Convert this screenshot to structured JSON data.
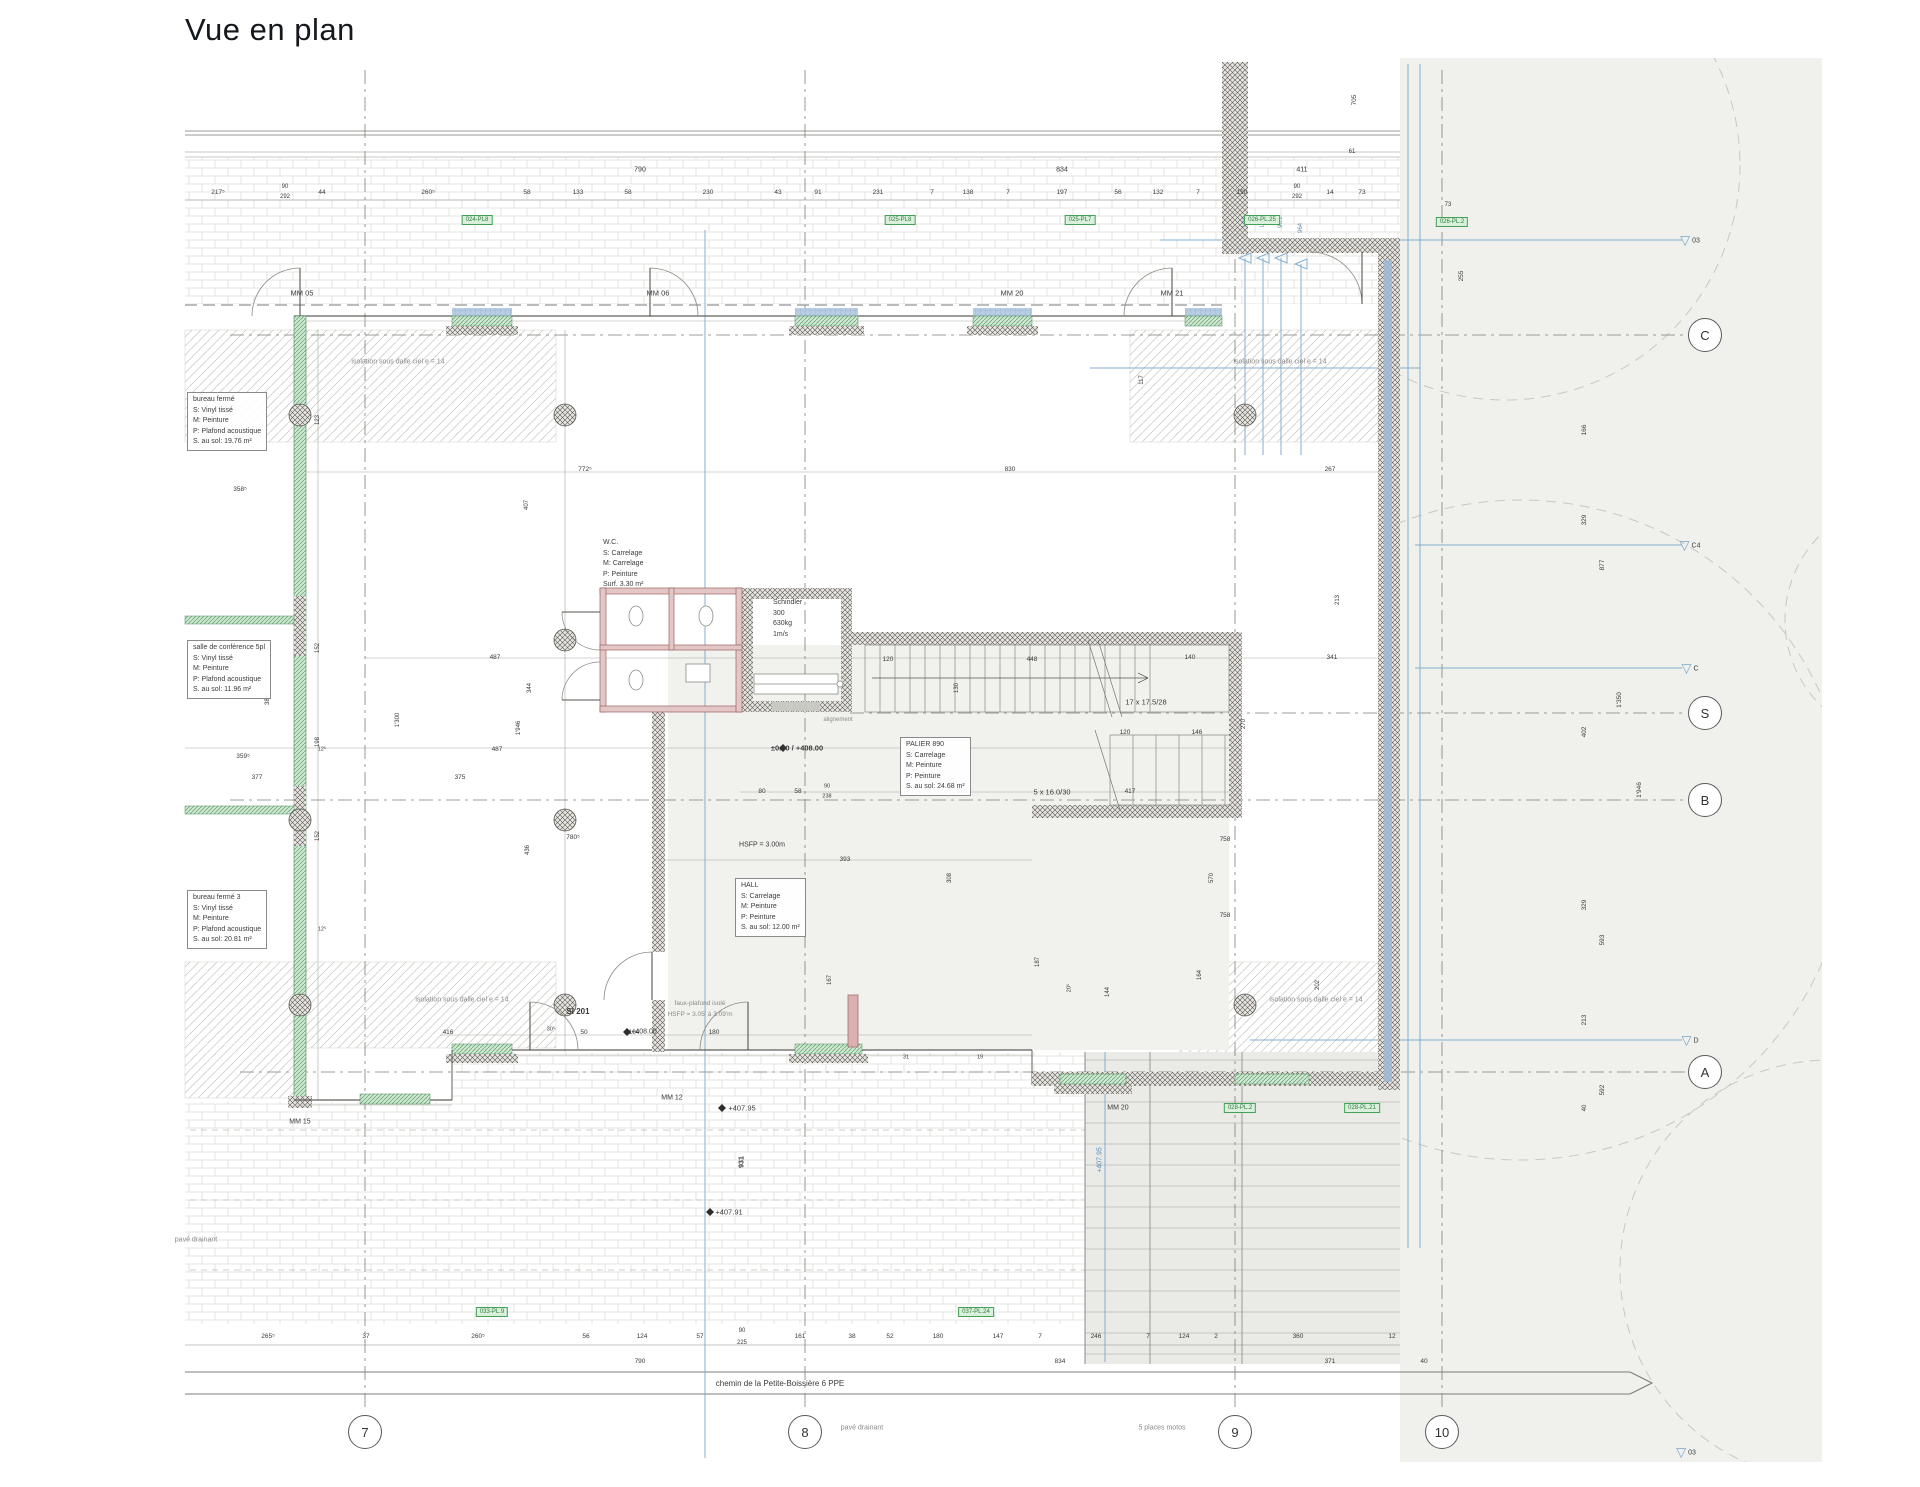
{
  "title": "Vue en plan",
  "colors": {
    "accent_green": "#43a056",
    "wall": "#5d5852",
    "glass": "#5fa06c",
    "blue_line": "#84aecf",
    "red_wall": "#9a6363"
  },
  "street": {
    "name_label": "chemin de la Petite-Boissière 6 PPE"
  },
  "grid": {
    "bubble_row_y": 1432,
    "bubble_col_x": 1705,
    "cols": [
      {
        "label": "7",
        "x": 365
      },
      {
        "label": "8",
        "x": 805
      },
      {
        "label": "9",
        "x": 1235
      },
      {
        "label": "10",
        "x": 1442
      }
    ],
    "rows": [
      {
        "label": "C",
        "y": 335
      },
      {
        "label": "S",
        "y": 713
      },
      {
        "label": "B",
        "y": 800
      },
      {
        "label": "A",
        "y": 1072
      }
    ],
    "triangles": [
      {
        "label": "03",
        "x": 1690,
        "y": 240
      },
      {
        "label": "C4",
        "x": 1690,
        "y": 545
      },
      {
        "label": "C",
        "x": 1690,
        "y": 668
      },
      {
        "label": "D",
        "x": 1690,
        "y": 1040
      },
      {
        "label": "03",
        "x": 1686,
        "y": 1452
      }
    ]
  },
  "rooms": [
    {
      "name": "bureau-ferme",
      "x": 187,
      "y": 392,
      "boxed": true,
      "lines": [
        "bureau fermé",
        "S: Vinyl tissé",
        "M: Peinture",
        "P: Plafond acoustique",
        "S. au sol: 19.76 m²"
      ]
    },
    {
      "name": "salle-de-conference",
      "x": 187,
      "y": 640,
      "boxed": true,
      "lines": [
        "salle de conférence 5pl",
        "S: Vinyl tissé",
        "M: Peinture",
        "P: Plafond acoustique",
        "S. au sol: 11.96 m²"
      ]
    },
    {
      "name": "bureau-ferme-3",
      "x": 187,
      "y": 890,
      "boxed": true,
      "lines": [
        "bureau fermé 3",
        "S: Vinyl tissé",
        "M: Peinture",
        "P: Plafond acoustique",
        "S. au sol: 20.81 m²"
      ]
    },
    {
      "name": "wc",
      "x": 598,
      "y": 536,
      "boxed": false,
      "lines": [
        "W.C.",
        "S: Carrelage",
        "M: Carrelage",
        "P: Peinture",
        "Surf. 3.30 m²"
      ]
    },
    {
      "name": "ascenseur",
      "x": 768,
      "y": 596,
      "boxed": false,
      "lines": [
        "Schindler",
        "300",
        "630kg",
        "1m/s"
      ]
    },
    {
      "name": "palier",
      "x": 900,
      "y": 737,
      "boxed": true,
      "lines": [
        "PALIER   890",
        "S: Carrelage",
        "M: Peinture",
        "P: Peinture",
        "S. au sol: 24.68 m²"
      ]
    },
    {
      "name": "hall",
      "x": 735,
      "y": 878,
      "boxed": true,
      "lines": [
        "HALL",
        "S: Carrelage",
        "M: Peinture",
        "P: Peinture",
        "S. au sol: 12.00 m²"
      ]
    }
  ],
  "badges": [
    {
      "t": "024-PL8",
      "x": 477,
      "y": 220
    },
    {
      "t": "025-PL8",
      "x": 900,
      "y": 220
    },
    {
      "t": "025-PL7",
      "x": 1080,
      "y": 220
    },
    {
      "t": "026-PL.25",
      "x": 1262,
      "y": 220
    },
    {
      "t": "026-PL.2",
      "x": 1452,
      "y": 222
    },
    {
      "t": "028-PL.2",
      "x": 1240,
      "y": 1108
    },
    {
      "t": "028-PL.21",
      "x": 1362,
      "y": 1108
    },
    {
      "t": "033-PL.9",
      "x": 492,
      "y": 1312
    },
    {
      "t": "037-PL.24",
      "x": 976,
      "y": 1312
    }
  ],
  "labels": [
    {
      "t": "790",
      "x": 640,
      "y": 170
    },
    {
      "t": "834",
      "x": 1062,
      "y": 170
    },
    {
      "t": "411",
      "x": 1302,
      "y": 170
    },
    {
      "t": "61",
      "x": 1352,
      "y": 152,
      "fs": 6
    },
    {
      "t": "217⁵",
      "x": 218,
      "y": 193,
      "fs": 6.5
    },
    {
      "t": "90",
      "x": 285,
      "y": 187,
      "fs": 6
    },
    {
      "t": "292",
      "x": 285,
      "y": 197,
      "fs": 6
    },
    {
      "t": "44",
      "x": 322,
      "y": 193,
      "fs": 6.5
    },
    {
      "t": "260⁵",
      "x": 428,
      "y": 193,
      "fs": 6.5
    },
    {
      "t": "58",
      "x": 527,
      "y": 193,
      "fs": 6.5
    },
    {
      "t": "133",
      "x": 578,
      "y": 193,
      "fs": 6.5
    },
    {
      "t": "58",
      "x": 628,
      "y": 193,
      "fs": 6.5
    },
    {
      "t": "230",
      "x": 708,
      "y": 193,
      "fs": 6.5
    },
    {
      "t": "43",
      "x": 778,
      "y": 193,
      "fs": 6.5
    },
    {
      "t": "91",
      "x": 818,
      "y": 193,
      "fs": 6.5
    },
    {
      "t": "231",
      "x": 878,
      "y": 193,
      "fs": 6.5
    },
    {
      "t": "7",
      "x": 932,
      "y": 193,
      "fs": 6.5
    },
    {
      "t": "138",
      "x": 968,
      "y": 193,
      "fs": 6.5
    },
    {
      "t": "7",
      "x": 1008,
      "y": 193,
      "fs": 6.5
    },
    {
      "t": "197",
      "x": 1062,
      "y": 193,
      "fs": 6.5
    },
    {
      "t": "56",
      "x": 1118,
      "y": 193,
      "fs": 6.5
    },
    {
      "t": "132",
      "x": 1158,
      "y": 193,
      "fs": 6.5
    },
    {
      "t": "7",
      "x": 1198,
      "y": 193,
      "fs": 6.5
    },
    {
      "t": "190",
      "x": 1242,
      "y": 193,
      "fs": 6.5
    },
    {
      "t": "90",
      "x": 1297,
      "y": 187,
      "fs": 6
    },
    {
      "t": "292",
      "x": 1297,
      "y": 197,
      "fs": 6
    },
    {
      "t": "14",
      "x": 1330,
      "y": 193,
      "fs": 6.5
    },
    {
      "t": "73",
      "x": 1362,
      "y": 193,
      "fs": 6.5
    },
    {
      "t": "MM 05",
      "x": 302,
      "y": 293,
      "fs": 7.5
    },
    {
      "t": "MM 06",
      "x": 658,
      "y": 293,
      "fs": 7.5
    },
    {
      "t": "MM 20",
      "x": 1012,
      "y": 293,
      "fs": 7.5
    },
    {
      "t": "MM 21",
      "x": 1172,
      "y": 293,
      "fs": 7.5
    },
    {
      "t": "705",
      "x": 1355,
      "y": 100,
      "r": 1,
      "fs": 6.5
    },
    {
      "t": "255",
      "x": 1462,
      "y": 276,
      "r": 1,
      "fs": 6.5
    },
    {
      "t": "73",
      "x": 1448,
      "y": 205,
      "fs": 6
    },
    {
      "t": "117",
      "x": 1142,
      "y": 380,
      "r": 1,
      "fs": 6
    },
    {
      "t": "213",
      "x": 1338,
      "y": 600,
      "r": 1,
      "fs": 6
    },
    {
      "t": "L04",
      "x": 1245,
      "y": 222,
      "r": 1,
      "fs": 6,
      "c": "b2"
    },
    {
      "t": "L03",
      "x": 1263,
      "y": 222,
      "r": 1,
      "fs": 6,
      "c": "b2"
    },
    {
      "t": "96.2",
      "x": 1281,
      "y": 222,
      "r": 1,
      "fs": 6,
      "c": "b2"
    },
    {
      "t": "964",
      "x": 1301,
      "y": 228,
      "r": 1,
      "fs": 6,
      "c": "b2"
    },
    {
      "t": "isolation sous dalle ciel e = 14",
      "x": 398,
      "y": 362,
      "fs": 7,
      "c": "g"
    },
    {
      "t": "isolation sous dalle ciel e = 14",
      "x": 1280,
      "y": 362,
      "fs": 7,
      "c": "g"
    },
    {
      "t": "isolation sous dalle ciel e = 14",
      "x": 462,
      "y": 1000,
      "fs": 7,
      "c": "g"
    },
    {
      "t": "isolation sous dalle ciel e = 14",
      "x": 1316,
      "y": 1000,
      "fs": 7,
      "c": "g"
    },
    {
      "t": "358⁵",
      "x": 240,
      "y": 490,
      "fs": 6.5
    },
    {
      "t": "359⁵",
      "x": 243,
      "y": 757,
      "fs": 6.5
    },
    {
      "t": "359⁵",
      "x": 240,
      "y": 932,
      "fs": 6.5
    },
    {
      "t": "377",
      "x": 257,
      "y": 778,
      "fs": 6.5
    },
    {
      "t": "375",
      "x": 460,
      "y": 778,
      "fs": 6.5
    },
    {
      "t": "487",
      "x": 495,
      "y": 658,
      "fs": 6.5
    },
    {
      "t": "487",
      "x": 497,
      "y": 750,
      "fs": 6.5
    },
    {
      "t": "772⁵",
      "x": 585,
      "y": 470,
      "fs": 6.5
    },
    {
      "t": "830",
      "x": 1010,
      "y": 470,
      "fs": 6.5
    },
    {
      "t": "267",
      "x": 1330,
      "y": 470,
      "fs": 6.5
    },
    {
      "t": "140",
      "x": 1190,
      "y": 658,
      "fs": 6.5
    },
    {
      "t": "341",
      "x": 1332,
      "y": 658,
      "fs": 6.5
    },
    {
      "t": "123",
      "x": 318,
      "y": 420,
      "r": 1,
      "fs": 6
    },
    {
      "t": "407",
      "x": 527,
      "y": 505,
      "r": 1,
      "fs": 6
    },
    {
      "t": "1'300",
      "x": 398,
      "y": 720,
      "r": 1,
      "fs": 6
    },
    {
      "t": "1'946",
      "x": 519,
      "y": 728,
      "r": 1,
      "fs": 6
    },
    {
      "t": "344",
      "x": 530,
      "y": 688,
      "r": 1,
      "fs": 6
    },
    {
      "t": "152",
      "x": 318,
      "y": 648,
      "r": 1,
      "fs": 6
    },
    {
      "t": "198",
      "x": 318,
      "y": 742,
      "r": 1,
      "fs": 6
    },
    {
      "t": "152",
      "x": 318,
      "y": 836,
      "r": 1,
      "fs": 6
    },
    {
      "t": "386",
      "x": 268,
      "y": 700,
      "r": 1,
      "fs": 6
    },
    {
      "t": "12⁵",
      "x": 322,
      "y": 750,
      "fs": 5.5
    },
    {
      "t": "12⁵",
      "x": 322,
      "y": 930,
      "fs": 5.5
    },
    {
      "t": "120",
      "x": 888,
      "y": 660,
      "fs": 6.5
    },
    {
      "t": "448",
      "x": 1032,
      "y": 660,
      "fs": 6.5
    },
    {
      "t": "130",
      "x": 957,
      "y": 688,
      "r": 1,
      "fs": 6
    },
    {
      "t": "120",
      "x": 1125,
      "y": 733,
      "fs": 6.5
    },
    {
      "t": "146",
      "x": 1197,
      "y": 733,
      "fs": 6.5
    },
    {
      "t": "270",
      "x": 1244,
      "y": 724,
      "r": 1,
      "fs": 6
    },
    {
      "t": "213",
      "x": 953,
      "y": 783,
      "r": 1,
      "fs": 6
    },
    {
      "t": "17 x 17.5/28",
      "x": 1146,
      "y": 702,
      "fs": 7.5
    },
    {
      "t": "5 x 16.0/30",
      "x": 1052,
      "y": 792,
      "fs": 7.5
    },
    {
      "t": "alignement",
      "x": 838,
      "y": 720,
      "fs": 6,
      "c": "g"
    },
    {
      "t": "±0.00 / +408.00",
      "x": 797,
      "y": 748,
      "fs": 7.5,
      "w": 1
    },
    {
      "t": "80",
      "x": 762,
      "y": 792,
      "fs": 6.5
    },
    {
      "t": "58",
      "x": 798,
      "y": 792,
      "fs": 6.5
    },
    {
      "t": "90",
      "x": 827,
      "y": 787,
      "fs": 5.5
    },
    {
      "t": "238",
      "x": 827,
      "y": 797,
      "fs": 5.5
    },
    {
      "t": "245",
      "x": 962,
      "y": 792,
      "fs": 6.5
    },
    {
      "t": "417",
      "x": 1130,
      "y": 792,
      "fs": 6.5
    },
    {
      "t": "758",
      "x": 1225,
      "y": 840,
      "fs": 6.5
    },
    {
      "t": "570",
      "x": 1212,
      "y": 878,
      "r": 1,
      "fs": 6
    },
    {
      "t": "758",
      "x": 1225,
      "y": 916,
      "fs": 6.5
    },
    {
      "t": "164",
      "x": 1200,
      "y": 975,
      "r": 1,
      "fs": 6
    },
    {
      "t": "187",
      "x": 1038,
      "y": 962,
      "r": 1,
      "fs": 6
    },
    {
      "t": "202",
      "x": 1318,
      "y": 985,
      "r": 1,
      "fs": 6
    },
    {
      "t": "144",
      "x": 1108,
      "y": 992,
      "r": 1,
      "fs": 6
    },
    {
      "t": "167",
      "x": 830,
      "y": 980,
      "r": 1,
      "fs": 6
    },
    {
      "t": "20⁵",
      "x": 1070,
      "y": 988,
      "r": 1,
      "fs": 5.5
    },
    {
      "t": "31",
      "x": 906,
      "y": 1058,
      "fs": 5.5
    },
    {
      "t": "19",
      "x": 980,
      "y": 1058,
      "fs": 5.5
    },
    {
      "t": "393",
      "x": 845,
      "y": 860,
      "fs": 6.5
    },
    {
      "t": "308",
      "x": 950,
      "y": 878,
      "r": 1,
      "fs": 6
    },
    {
      "t": "HSFP = 3.00m",
      "x": 762,
      "y": 845,
      "fs": 7
    },
    {
      "t": "780⁵",
      "x": 573,
      "y": 838,
      "fs": 6.5
    },
    {
      "t": "436",
      "x": 528,
      "y": 850,
      "r": 1,
      "fs": 6
    },
    {
      "t": "931",
      "x": 742,
      "y": 1162,
      "r": 1,
      "fs": 7,
      "w": 1
    },
    {
      "t": "416",
      "x": 448,
      "y": 1033,
      "fs": 6.5
    },
    {
      "t": "30⁵",
      "x": 551,
      "y": 1030,
      "fs": 5.5
    },
    {
      "t": "50",
      "x": 584,
      "y": 1033,
      "fs": 6.5
    },
    {
      "t": "104",
      "x": 634,
      "y": 1033,
      "fs": 6.5
    },
    {
      "t": "180",
      "x": 714,
      "y": 1033,
      "fs": 6.5
    },
    {
      "t": "SI 201",
      "x": 578,
      "y": 1012,
      "fs": 8,
      "w": 1
    },
    {
      "t": "+408.00",
      "x": 644,
      "y": 1032,
      "fs": 7
    },
    {
      "t": "faux-plafond isolé",
      "x": 700,
      "y": 1004,
      "fs": 6.5,
      "c": "g"
    },
    {
      "t": "HSFP = 3.05' à 3.09'm",
      "x": 700,
      "y": 1015,
      "fs": 6.5,
      "c": "g"
    },
    {
      "t": "MM 12",
      "x": 672,
      "y": 1098,
      "fs": 7
    },
    {
      "t": "MM 15",
      "x": 300,
      "y": 1122,
      "fs": 7
    },
    {
      "t": "MM 20",
      "x": 1118,
      "y": 1108,
      "fs": 7
    },
    {
      "t": "+407.95",
      "x": 742,
      "y": 1108,
      "fs": 7.5
    },
    {
      "t": "+407.91",
      "x": 729,
      "y": 1212,
      "fs": 7.5
    },
    {
      "t": "+407.95",
      "x": 1100,
      "y": 1160,
      "r": 1,
      "fs": 7,
      "c": "b2"
    },
    {
      "t": "pavé drainant",
      "x": 196,
      "y": 1240,
      "fs": 7,
      "c": "g"
    },
    {
      "t": "166",
      "x": 1585,
      "y": 430,
      "r": 1,
      "fs": 6.5
    },
    {
      "t": "329",
      "x": 1585,
      "y": 520,
      "r": 1,
      "fs": 6.5
    },
    {
      "t": "877",
      "x": 1603,
      "y": 565,
      "r": 1,
      "fs": 6.5
    },
    {
      "t": "402",
      "x": 1585,
      "y": 732,
      "r": 1,
      "fs": 6.5
    },
    {
      "t": "1'350",
      "x": 1620,
      "y": 700,
      "r": 1,
      "fs": 6.5
    },
    {
      "t": "329",
      "x": 1585,
      "y": 905,
      "r": 1,
      "fs": 6.5
    },
    {
      "t": "593",
      "x": 1603,
      "y": 940,
      "r": 1,
      "fs": 6.5
    },
    {
      "t": "213",
      "x": 1585,
      "y": 1020,
      "r": 1,
      "fs": 6.5
    },
    {
      "t": "1'946",
      "x": 1640,
      "y": 790,
      "r": 1,
      "fs": 6.5
    },
    {
      "t": "592",
      "x": 1603,
      "y": 1090,
      "r": 1,
      "fs": 6.5
    },
    {
      "t": "40",
      "x": 1585,
      "y": 1108,
      "r": 1,
      "fs": 6
    },
    {
      "t": "265⁵",
      "x": 268,
      "y": 1337,
      "fs": 6.5
    },
    {
      "t": "37",
      "x": 366,
      "y": 1337,
      "fs": 6.5
    },
    {
      "t": "260⁵",
      "x": 478,
      "y": 1337,
      "fs": 6.5
    },
    {
      "t": "56",
      "x": 586,
      "y": 1337,
      "fs": 6.5
    },
    {
      "t": "124",
      "x": 642,
      "y": 1337,
      "fs": 6.5
    },
    {
      "t": "57",
      "x": 700,
      "y": 1337,
      "fs": 6.5
    },
    {
      "t": "90",
      "x": 742,
      "y": 1331,
      "fs": 6
    },
    {
      "t": "225",
      "x": 742,
      "y": 1343,
      "fs": 6
    },
    {
      "t": "161",
      "x": 800,
      "y": 1337,
      "fs": 6.5
    },
    {
      "t": "38",
      "x": 852,
      "y": 1337,
      "fs": 6.5
    },
    {
      "t": "52",
      "x": 890,
      "y": 1337,
      "fs": 6.5
    },
    {
      "t": "180",
      "x": 938,
      "y": 1337,
      "fs": 6.5
    },
    {
      "t": "147",
      "x": 998,
      "y": 1337,
      "fs": 6.5
    },
    {
      "t": "7",
      "x": 1040,
      "y": 1337,
      "fs": 6.5
    },
    {
      "t": "246",
      "x": 1096,
      "y": 1337,
      "fs": 6.5
    },
    {
      "t": "7",
      "x": 1148,
      "y": 1337,
      "fs": 6.5
    },
    {
      "t": "124",
      "x": 1184,
      "y": 1337,
      "fs": 6.5
    },
    {
      "t": "2",
      "x": 1216,
      "y": 1337,
      "fs": 6.5
    },
    {
      "t": "360",
      "x": 1298,
      "y": 1337,
      "fs": 6.5
    },
    {
      "t": "12",
      "x": 1392,
      "y": 1337,
      "fs": 6.5
    },
    {
      "t": "790",
      "x": 640,
      "y": 1362,
      "fs": 6.5
    },
    {
      "t": "834",
      "x": 1060,
      "y": 1362,
      "fs": 6.5
    },
    {
      "t": "371",
      "x": 1330,
      "y": 1362,
      "fs": 6.5
    },
    {
      "t": "40",
      "x": 1424,
      "y": 1362,
      "fs": 6.5
    },
    {
      "t": "chemin de la Petite-Boissière 6 PPE",
      "x": 780,
      "y": 1384,
      "fs": 8
    },
    {
      "t": "pavé drainant",
      "x": 862,
      "y": 1428,
      "fs": 7,
      "c": "g"
    },
    {
      "t": "5 places motos",
      "x": 1162,
      "y": 1428,
      "fs": 7,
      "c": "g"
    }
  ]
}
